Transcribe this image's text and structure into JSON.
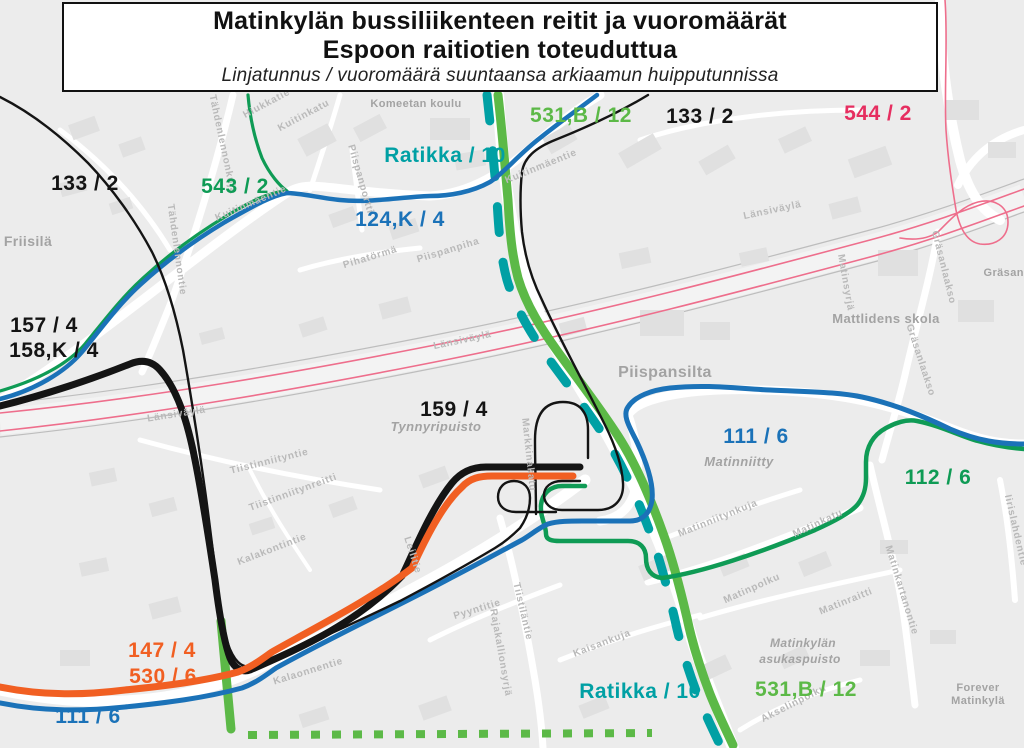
{
  "title": {
    "line1": "Matinkylän bussiliikenteen reitit ja vuoromäärät",
    "line2": "Espoon raitiotien toteuduttua",
    "subtitle": "Linjatunnus / vuoromäärä suuntaansa arkiaamun huipputunnissa"
  },
  "colors": {
    "light_green": "#5CB947",
    "dark_green": "#0F9B55",
    "teal": "#00A0A4",
    "blue": "#1B72B8",
    "orange": "#F15F22",
    "pink_line": "#EE6E8C",
    "pink_label": "#E62E60",
    "black": "#141414",
    "map_bg": "#ececec",
    "building": "#e2e2e2",
    "street": "#ffffff",
    "street_label": "#b9b9b9",
    "place_label": "#a3a3a3"
  },
  "routes": [
    {
      "id": "highway-band",
      "color": "#f3f3f3",
      "width": 26
    },
    {
      "id": "highway-edge-top",
      "color": "#bdbdbd",
      "width": 1.2
    },
    {
      "id": "highway-edge-bottom",
      "color": "#bdbdbd",
      "width": 1.2
    },
    {
      "id": "route-544-a",
      "label": "544 / 2",
      "color": "#EE6E8C",
      "width": 1.6
    },
    {
      "id": "route-544-b",
      "label": "544 / 2",
      "color": "#EE6E8C",
      "width": 1.6
    },
    {
      "id": "route-544-ramp",
      "label": "544 / 2",
      "color": "#EE6E8C",
      "width": 1.6
    },
    {
      "id": "ratikka-dashed",
      "label": "Ratikka / 10",
      "color": "#00A0A4",
      "width": 9
    },
    {
      "id": "ratikka-corridor",
      "label": "531,B / 12",
      "color": "#5CB947",
      "width": 9
    },
    {
      "id": "route-531-branch",
      "label": "531,B / 12",
      "color": "#5CB947",
      "width": 9
    },
    {
      "id": "route-531-dotted",
      "label": "531,B / 12",
      "color": "#5CB947",
      "width": 8
    },
    {
      "id": "route-543",
      "label": "543 / 2",
      "color": "#0F9B55",
      "width": 3.2
    },
    {
      "id": "route-112",
      "label": "112 / 6",
      "color": "#0F9B55",
      "width": 4.5
    },
    {
      "id": "route-124k",
      "label": "124,K / 4",
      "color": "#1B72B8",
      "width": 4.5
    },
    {
      "id": "route-111",
      "label": "111 / 6",
      "color": "#1B72B8",
      "width": 5
    },
    {
      "id": "route-133-nw-loop",
      "label": "133 / 2",
      "color": "#141414",
      "width": 2.4
    },
    {
      "id": "route-133-ne",
      "label": "133 / 2",
      "color": "#141414",
      "width": 2.4
    },
    {
      "id": "route-159-stub",
      "label": "159 / 4",
      "color": "#141414",
      "width": 2.4
    },
    {
      "id": "route-157-158",
      "label": "157 / 4  158,K / 4",
      "color": "#141414",
      "width": 7
    },
    {
      "id": "route-147-530",
      "label": "147 / 4  530 / 6",
      "color": "#F15F22",
      "width": 7
    }
  ],
  "route_labels": [
    {
      "text": "531,B / 12",
      "x": 581,
      "y": 122,
      "color": "#5CB947",
      "size": 21
    },
    {
      "text": "133 / 2",
      "x": 700,
      "y": 123,
      "color": "#141414",
      "size": 21
    },
    {
      "text": "544 / 2",
      "x": 878,
      "y": 120,
      "color": "#E62E60",
      "size": 21
    },
    {
      "text": "Ratikka / 10",
      "x": 445,
      "y": 162,
      "color": "#00A0A4",
      "size": 21
    },
    {
      "text": "133 / 2",
      "x": 85,
      "y": 190,
      "color": "#141414",
      "size": 21
    },
    {
      "text": "543 / 2",
      "x": 235,
      "y": 193,
      "color": "#0F9B55",
      "size": 21
    },
    {
      "text": "124,K / 4",
      "x": 400,
      "y": 226,
      "color": "#1B72B8",
      "size": 21
    },
    {
      "text": "157 / 4",
      "x": 44,
      "y": 332,
      "color": "#141414",
      "size": 21
    },
    {
      "text": "158,K / 4",
      "x": 54,
      "y": 357,
      "color": "#141414",
      "size": 21
    },
    {
      "text": "159 / 4",
      "x": 454,
      "y": 416,
      "color": "#141414",
      "size": 21
    },
    {
      "text": "111 / 6",
      "x": 756,
      "y": 443,
      "color": "#1B72B8",
      "size": 21
    },
    {
      "text": "112 / 6",
      "x": 938,
      "y": 484,
      "color": "#0F9B55",
      "size": 21
    },
    {
      "text": "147 / 4",
      "x": 162,
      "y": 657,
      "color": "#F15F22",
      "size": 21
    },
    {
      "text": "530 / 6",
      "x": 163,
      "y": 683,
      "color": "#F15F22",
      "size": 21
    },
    {
      "text": "111 / 6",
      "x": 88,
      "y": 723,
      "color": "#1B72B8",
      "size": 21
    },
    {
      "text": "Ratikka / 10",
      "x": 640,
      "y": 698,
      "color": "#00A0A4",
      "size": 21
    },
    {
      "text": "531,B / 12",
      "x": 806,
      "y": 696,
      "color": "#5CB947",
      "size": 21
    }
  ],
  "place_labels": [
    {
      "text": "Komeetan koulu",
      "x": 416,
      "y": 107,
      "size": 11,
      "italic": false
    },
    {
      "text": "Friisilä",
      "x": 28,
      "y": 246,
      "size": 14,
      "italic": false
    },
    {
      "text": "Piispansilta",
      "x": 665,
      "y": 377,
      "size": 16,
      "italic": false
    },
    {
      "text": "Mattlidens skola",
      "x": 886,
      "y": 323,
      "size": 13,
      "italic": false
    },
    {
      "text": "Tynnyripuisto",
      "x": 436,
      "y": 431,
      "size": 13,
      "italic": true
    },
    {
      "text": "Matinniitty",
      "x": 739,
      "y": 466,
      "size": 13,
      "italic": true
    },
    {
      "text": "Matinkylän",
      "x": 803,
      "y": 647,
      "size": 12,
      "italic": true
    },
    {
      "text": "asukaspuisto",
      "x": 800,
      "y": 663,
      "size": 12,
      "italic": true
    },
    {
      "text": "Forever",
      "x": 978,
      "y": 691,
      "size": 11,
      "italic": false
    },
    {
      "text": "Matinkylä",
      "x": 978,
      "y": 704,
      "size": 11,
      "italic": false
    },
    {
      "text": "Gräsanlaakso",
      "x": 1022,
      "y": 276,
      "size": 11,
      "italic": false
    }
  ],
  "street_labels": [
    {
      "text": "Hiukkatie",
      "x": 268,
      "y": 106,
      "rot": -28
    },
    {
      "text": "Kuitinkatu",
      "x": 305,
      "y": 118,
      "rot": -28
    },
    {
      "text": "Tähdenlennonkuja",
      "x": 220,
      "y": 145,
      "rot": 78
    },
    {
      "text": "Tähdenlennontie",
      "x": 174,
      "y": 250,
      "rot": 82
    },
    {
      "text": "Kuitinmäentie",
      "x": 252,
      "y": 206,
      "rot": -23
    },
    {
      "text": "Kuitinmäentie",
      "x": 542,
      "y": 169,
      "rot": -22
    },
    {
      "text": "Piispanportti",
      "x": 358,
      "y": 180,
      "rot": 74
    },
    {
      "text": "Pihatörmä",
      "x": 371,
      "y": 260,
      "rot": -17
    },
    {
      "text": "Piispanpiha",
      "x": 449,
      "y": 253,
      "rot": -17
    },
    {
      "text": "Länsiväylä",
      "x": 177,
      "y": 417,
      "rot": -9
    },
    {
      "text": "Länsiväylä",
      "x": 463,
      "y": 343,
      "rot": -12
    },
    {
      "text": "Länsiväylä",
      "x": 773,
      "y": 213,
      "rot": -12
    },
    {
      "text": "Matinsyrjä",
      "x": 843,
      "y": 283,
      "rot": 80
    },
    {
      "text": "Gräsanlaakso",
      "x": 941,
      "y": 268,
      "rot": 76
    },
    {
      "text": "Gräsanlaakso",
      "x": 918,
      "y": 361,
      "rot": 72
    },
    {
      "text": "Tiistinniityntie",
      "x": 270,
      "y": 464,
      "rot": -14
    },
    {
      "text": "Tiistinniitynreitti",
      "x": 294,
      "y": 495,
      "rot": -20
    },
    {
      "text": "Kalakontintie",
      "x": 273,
      "y": 552,
      "rot": -21
    },
    {
      "text": "Leilitie",
      "x": 410,
      "y": 556,
      "rot": 72
    },
    {
      "text": "Markkinakatu",
      "x": 526,
      "y": 455,
      "rot": 84
    },
    {
      "text": "Matinniitynkuja",
      "x": 719,
      "y": 521,
      "rot": -22
    },
    {
      "text": "Matinkatu",
      "x": 819,
      "y": 526,
      "rot": -25
    },
    {
      "text": "Matinkartanontie",
      "x": 899,
      "y": 591,
      "rot": 73
    },
    {
      "text": "Iirislahdentie",
      "x": 1013,
      "y": 531,
      "rot": 77
    },
    {
      "text": "Pyyntitie",
      "x": 478,
      "y": 612,
      "rot": -17
    },
    {
      "text": "Tiistiläntie",
      "x": 520,
      "y": 612,
      "rot": 77
    },
    {
      "text": "Rajakallionsyrjä",
      "x": 498,
      "y": 653,
      "rot": 80
    },
    {
      "text": "Kalaonnentie",
      "x": 309,
      "y": 674,
      "rot": -17
    },
    {
      "text": "Kaisankuja",
      "x": 603,
      "y": 646,
      "rot": -21
    },
    {
      "text": "Matinpolku",
      "x": 753,
      "y": 591,
      "rot": -24
    },
    {
      "text": "Matinraitti",
      "x": 847,
      "y": 604,
      "rot": -22
    },
    {
      "text": "Akselinpolku",
      "x": 795,
      "y": 706,
      "rot": -27
    }
  ]
}
